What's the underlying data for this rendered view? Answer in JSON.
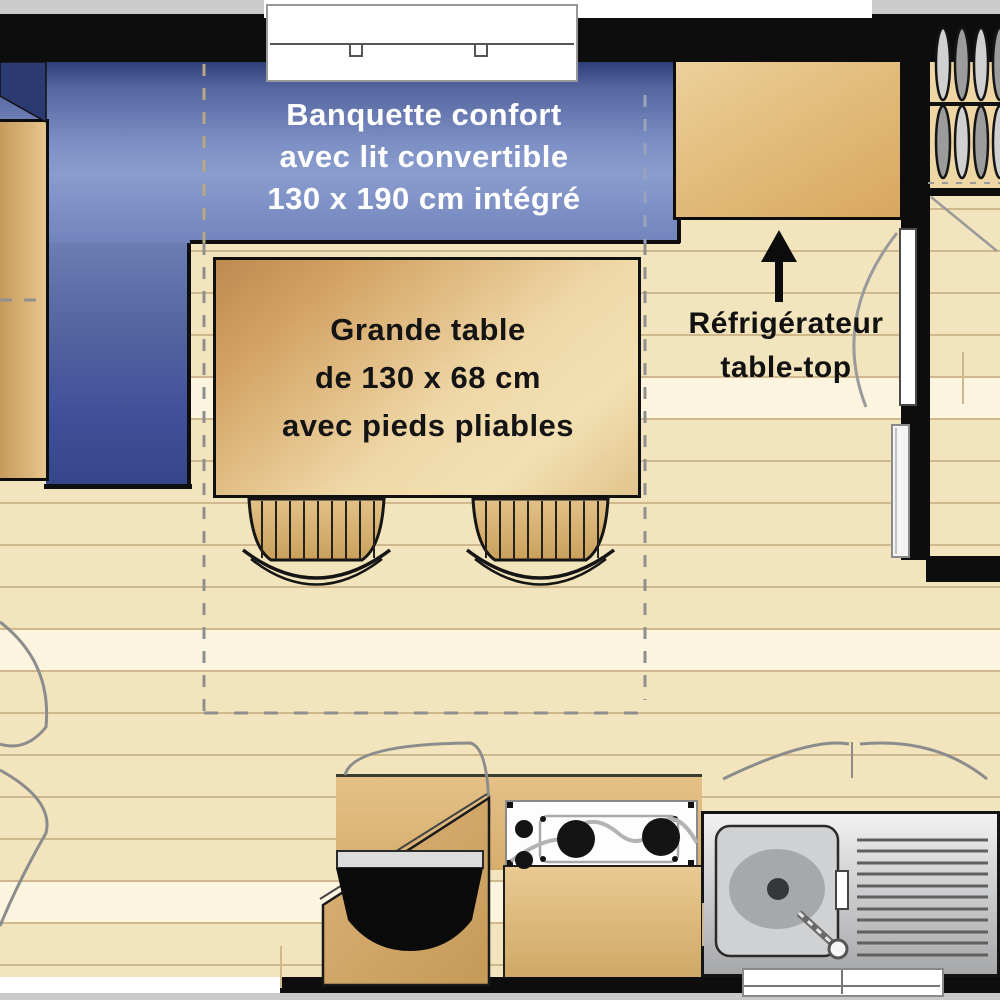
{
  "title": "Mobile home interior floor plan",
  "labels": {
    "banquette": {
      "line1": "Banquette confort",
      "line2": "avec lit convertible",
      "line3": "130 x 190 cm intégré",
      "text_color": "#ffffff"
    },
    "table": {
      "line1": "Grande table",
      "line2": "de 130 x 68 cm",
      "line3": "avec pieds pliables",
      "text_color": "#141414"
    },
    "fridge": {
      "line1": "Réfrigérateur",
      "line2": "table-top",
      "text_color": "#111111"
    }
  },
  "colors": {
    "wall": "#0d0d0d",
    "floor_base": "#f2e4bd",
    "plank_seam": "#cfb88b",
    "banquette_light_blue": "#8497cb",
    "banquette_navy": "#2f3e78",
    "wood_tan": "#d9ab66",
    "steel": "#c7c8ca",
    "swing_arc_gray": "#8c8c8c"
  },
  "elements": [
    "banquette-bench",
    "convertible-bed-dashed-outline",
    "dining-table",
    "stools",
    "left-side-cabinet",
    "fridge-top-cabinet",
    "fridge-location-arrow",
    "interior-door-with-swing-arc",
    "wardrobe-with-hangers",
    "kitchen-counters",
    "gas-hob",
    "washbasin-bowl",
    "stainless-sink-with-drainer",
    "top-window",
    "bottom-window",
    "cupboard-door-swing-arcs"
  ]
}
